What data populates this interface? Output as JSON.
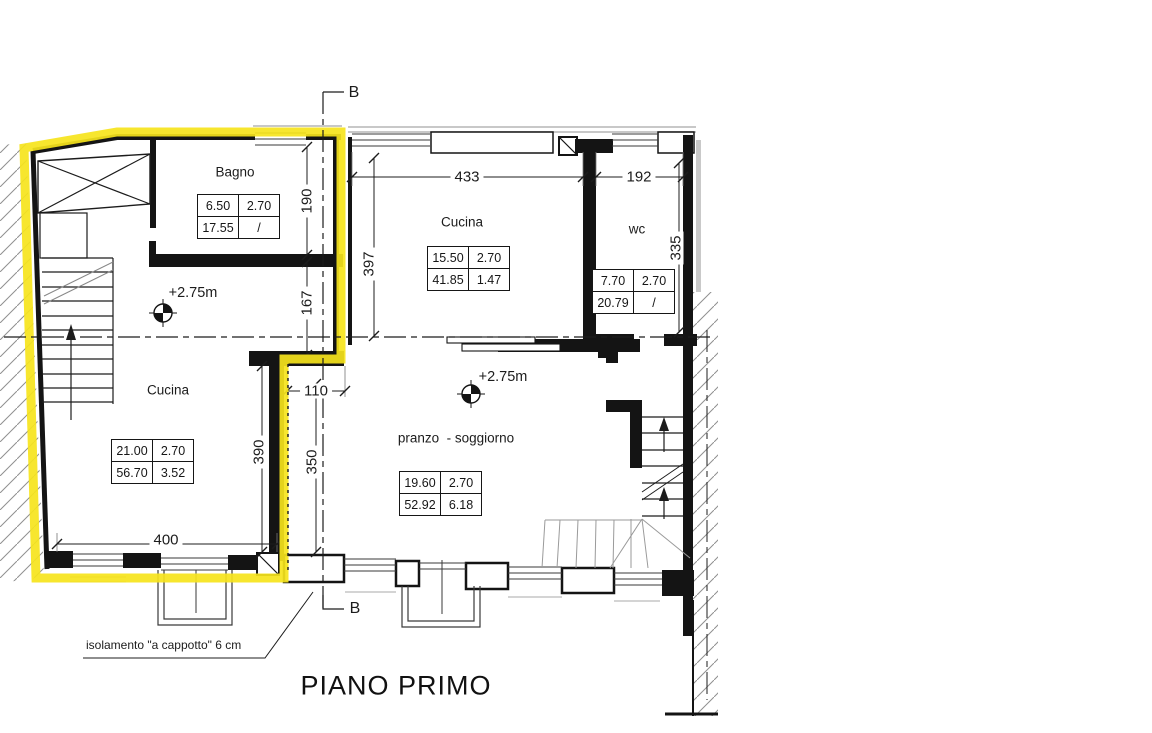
{
  "title": "PIANO PRIMO",
  "annotation": "isolamento \"a cappotto\" 6 cm",
  "section": {
    "top": "B",
    "bottom": "B"
  },
  "levels": {
    "cucina_left": "+2.75m",
    "pranzo": "+2.75m"
  },
  "colors": {
    "highlight": "#f6e41c",
    "wall": "#141414",
    "hatch": "#8f8f8f"
  },
  "rooms": {
    "bagno": {
      "name": "Bagno",
      "table": [
        [
          "6.50",
          "2.70"
        ],
        [
          "17.55",
          "/"
        ]
      ]
    },
    "cucina_top": {
      "name": "Cucina",
      "table": [
        [
          "15.50",
          "2.70"
        ],
        [
          "41.85",
          "1.47"
        ]
      ]
    },
    "wc": {
      "name": "wc",
      "table": [
        [
          "7.70",
          "2.70"
        ],
        [
          "20.79",
          "/"
        ]
      ]
    },
    "cucina_left": {
      "name": "Cucina",
      "table": [
        [
          "21.00",
          "2.70"
        ],
        [
          "56.70",
          "3.52"
        ]
      ]
    },
    "pranzo": {
      "name": "pranzo  - soggiorno",
      "table": [
        [
          "19.60",
          "2.70"
        ],
        [
          "52.92",
          "6.18"
        ]
      ]
    }
  },
  "dimensions": {
    "top_width": "433",
    "wc_width": "192",
    "bagno_height": "190",
    "mid_height": "167",
    "cucina_top_height": "397",
    "wc_height": "335",
    "step_width": "110",
    "cucina_left_height": "390",
    "pranzo_height": "350",
    "cucina_left_width": "400"
  }
}
